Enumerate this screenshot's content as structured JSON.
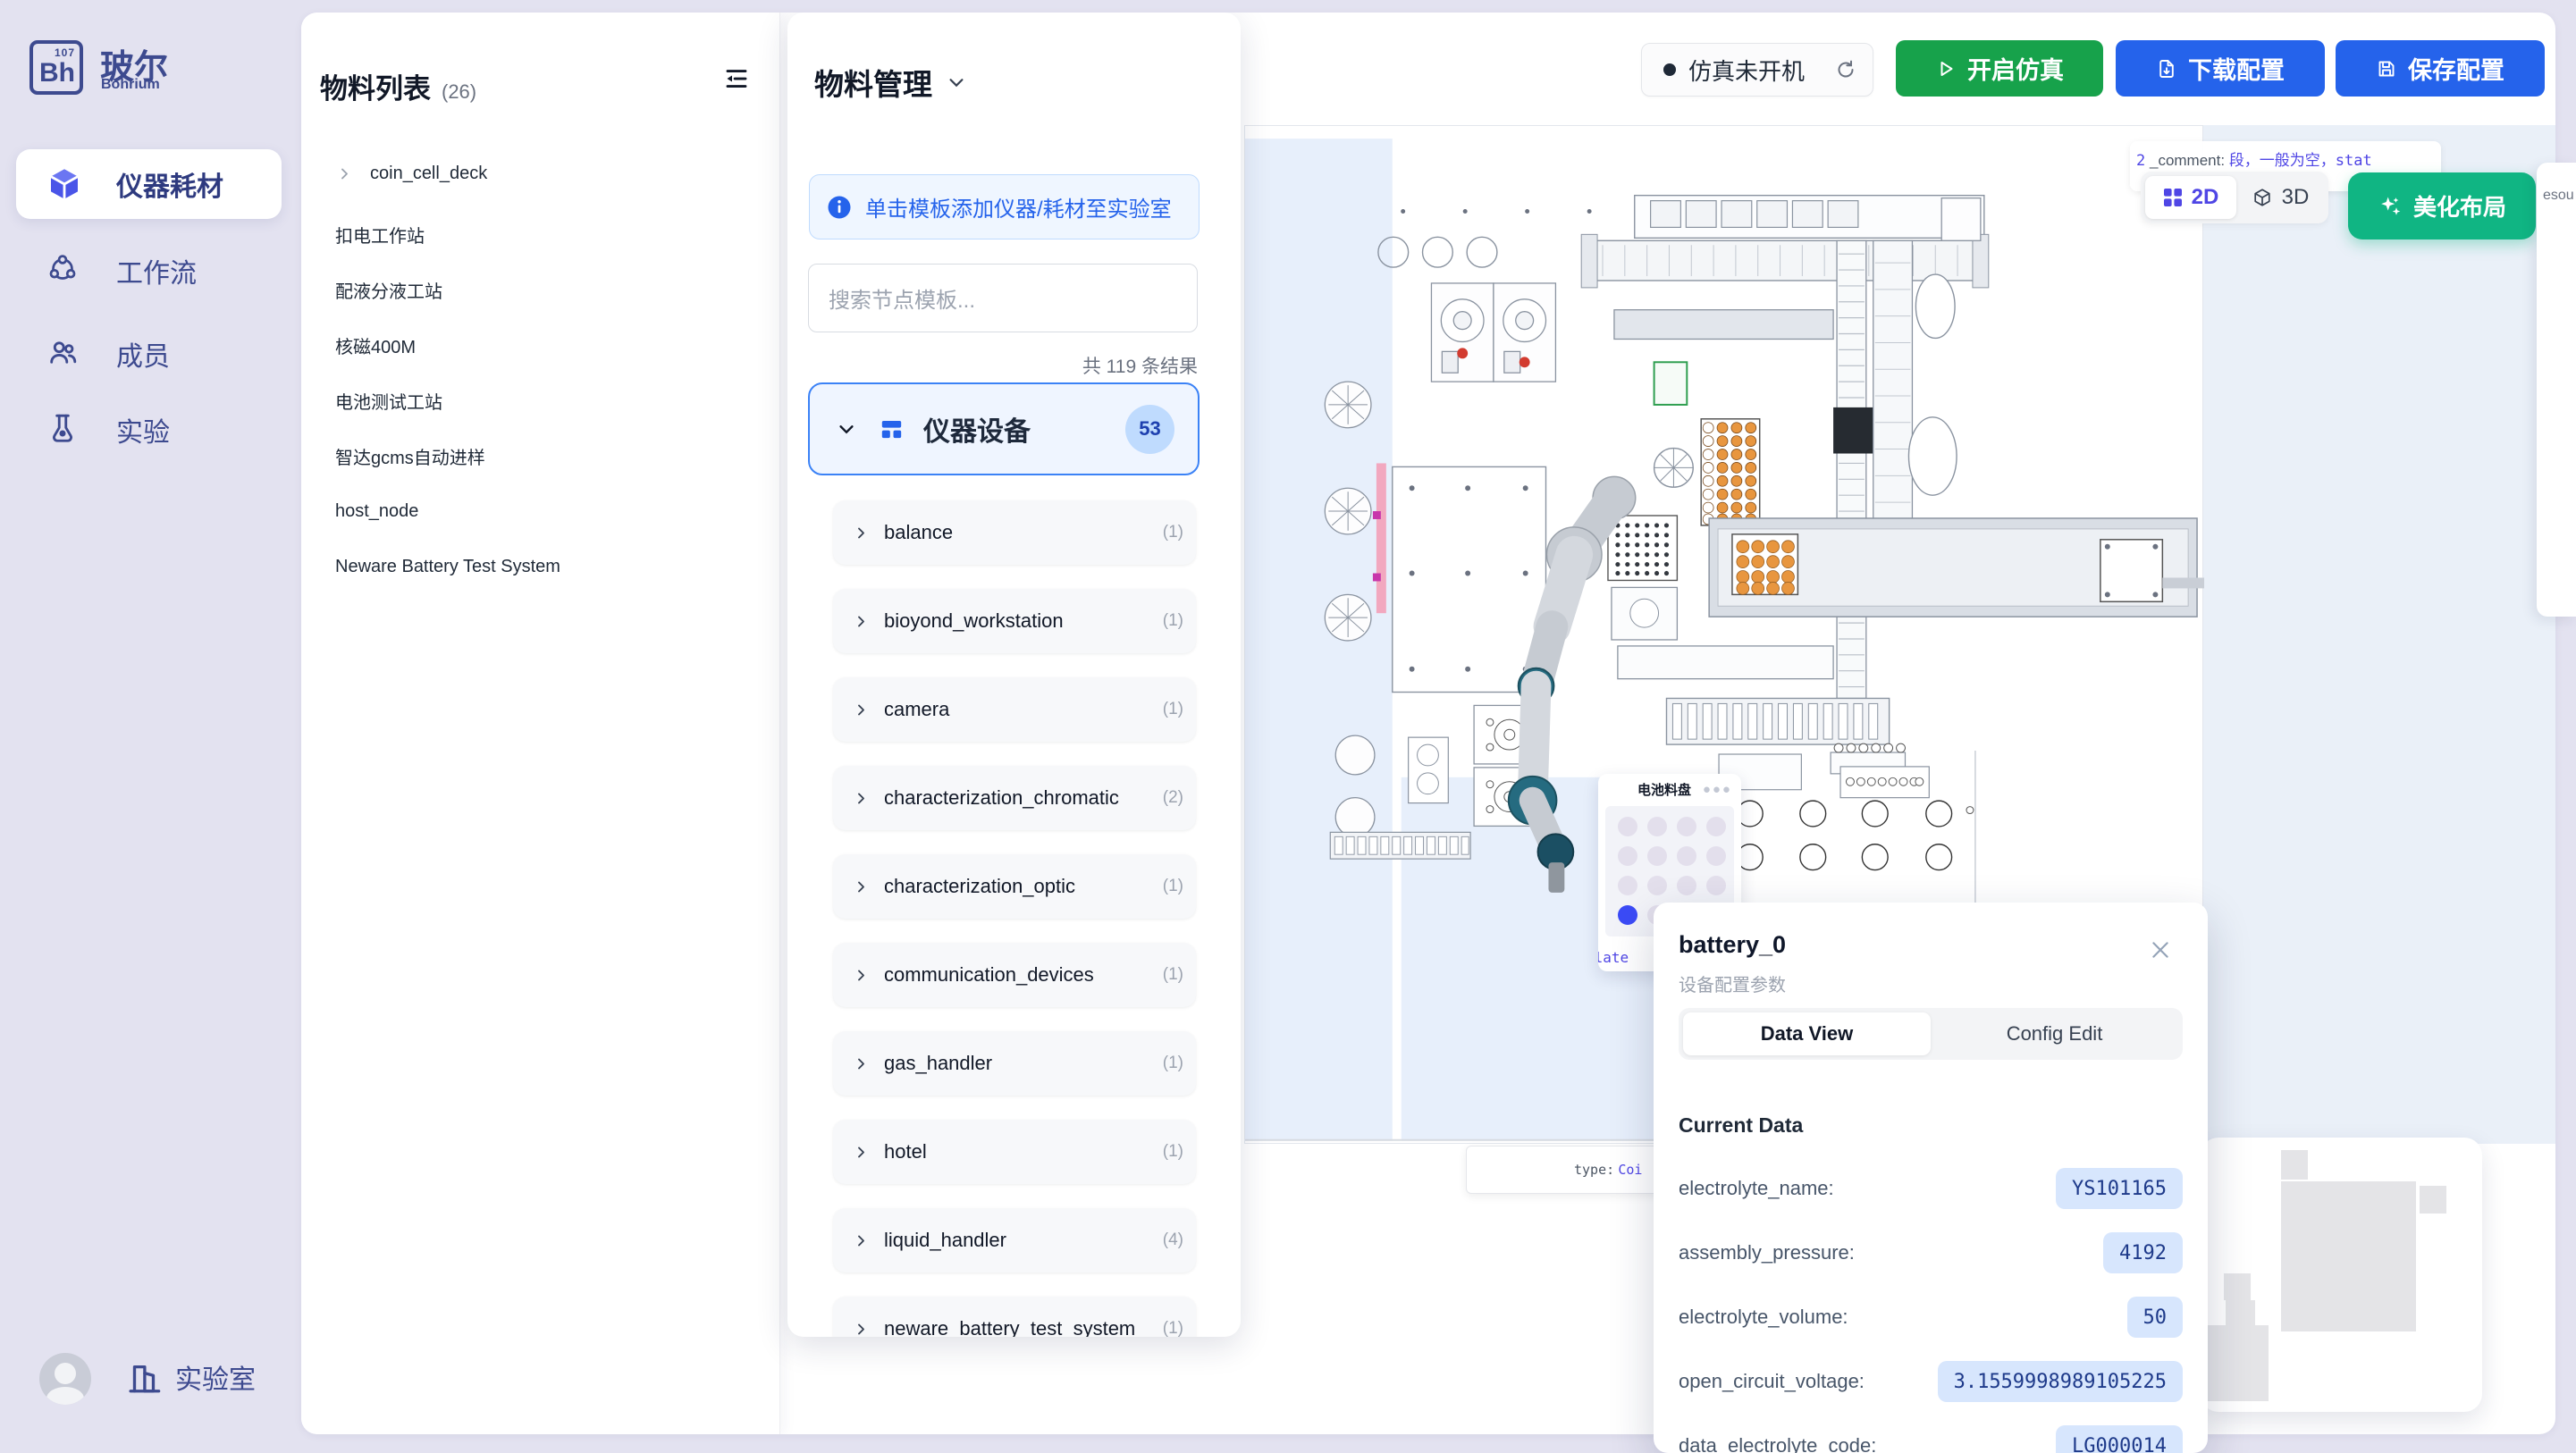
{
  "sidebar": {
    "logo": {
      "element": "Bh",
      "number": "107",
      "name": "玻尔",
      "subtitle": "Bohrium"
    },
    "nav": [
      {
        "label": "仪器耗材",
        "icon": "cube-icon",
        "active": true
      },
      {
        "label": "工作流",
        "icon": "workflow-icon",
        "active": false
      },
      {
        "label": "成员",
        "icon": "members-icon",
        "active": false
      },
      {
        "label": "实验",
        "icon": "experiment-icon",
        "active": false
      }
    ],
    "footer": {
      "label": "实验室"
    }
  },
  "materials": {
    "title": "物料列表",
    "count": "(26)",
    "items": [
      {
        "label": "coin_cell_deck",
        "expandable": true
      },
      {
        "label": "扣电工作站"
      },
      {
        "label": "配液分液工站"
      },
      {
        "label": "核磁400M"
      },
      {
        "label": "电池测试工站"
      },
      {
        "label": "智达gcms自动进样"
      },
      {
        "label": "host_node"
      },
      {
        "label": "Neware Battery Test System"
      }
    ]
  },
  "panel": {
    "title": "物料管理",
    "banner": "单击模板添加仪器/耗材至实验室",
    "search_placeholder": "搜索节点模板...",
    "results": "共 119 条结果",
    "category": {
      "name": "仪器设备",
      "count": "53"
    },
    "templates": [
      {
        "name": "balance",
        "count": "(1)"
      },
      {
        "name": "bioyond_workstation",
        "count": "(1)"
      },
      {
        "name": "camera",
        "count": "(1)"
      },
      {
        "name": "characterization_chromatic",
        "count": "(2)"
      },
      {
        "name": "characterization_optic",
        "count": "(1)"
      },
      {
        "name": "communication_devices",
        "count": "(1)"
      },
      {
        "name": "gas_handler",
        "count": "(1)"
      },
      {
        "name": "hotel",
        "count": "(1)"
      },
      {
        "name": "liquid_handler",
        "count": "(4)"
      },
      {
        "name": "neware_battery_test_system",
        "count": "(1)"
      }
    ]
  },
  "topbar": {
    "status": "仿真未开机",
    "start": "开启仿真",
    "download": "下载配置",
    "save": "保存配置"
  },
  "canvas": {
    "comment_tooltip": {
      "prefix": "2",
      "key": "_comment:",
      "value": "段，一般为空，stat",
      "line2": "法此固定"
    },
    "view_toggle": {
      "d2": "2D",
      "d3": "3D"
    },
    "beautify": "美化布局",
    "tray": {
      "title": "电池料盘",
      "rows": 4,
      "cols": 4,
      "active_row": 3,
      "active_col": 0,
      "plate_label": "Plate"
    },
    "type_tooltip": {
      "label": "type:",
      "value": "Coi"
    },
    "side_peek": "esou"
  },
  "popup": {
    "title": "battery_0",
    "subtitle": "设备配置参数",
    "tabs": [
      {
        "label": "Data View",
        "active": true
      },
      {
        "label": "Config Edit",
        "active": false
      }
    ],
    "section": "Current Data",
    "rows": [
      {
        "label": "electrolyte_name:",
        "value": "YS101165"
      },
      {
        "label": "assembly_pressure:",
        "value": "4192"
      },
      {
        "label": "electrolyte_volume:",
        "value": "50"
      },
      {
        "label": "open_circuit_voltage:",
        "value": "3.1559998989105225"
      },
      {
        "label": "data_electrolyte_code:",
        "value": "LG000014"
      }
    ]
  },
  "colors": {
    "accent_blue": "#2563EB",
    "accent_green": "#17A24B",
    "accent_teal": "#10B583",
    "accent_indigo": "#4F46E5",
    "selected_dot": "#3B4BF6"
  }
}
